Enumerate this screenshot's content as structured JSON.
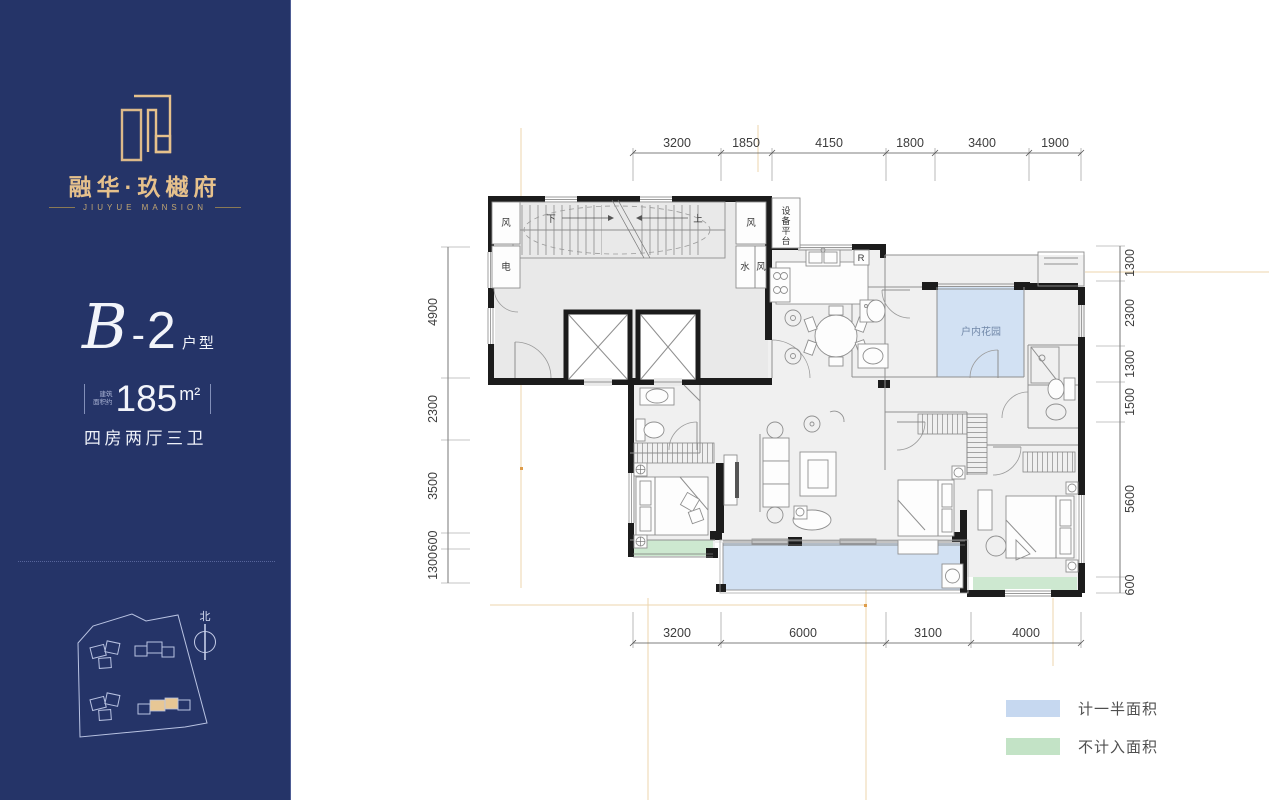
{
  "brand": {
    "title": "融华·玖樾府",
    "subtitle": "JIUYUE MANSION"
  },
  "unit": {
    "script": "B",
    "dash": "-",
    "number": "2",
    "suffix": "户型",
    "area_label_1": "建筑",
    "area_label_2": "面积约",
    "area_value": "185",
    "area_unit": "m²",
    "layout": "四房两厅三卫"
  },
  "compass": {
    "north": "北"
  },
  "plan": {
    "dims": {
      "top": [
        "3200",
        "1850",
        "4150",
        "1800",
        "3400",
        "1900"
      ],
      "left": [
        "4900",
        "2300",
        "3500",
        "600",
        "1300"
      ],
      "right": [
        "1300",
        "2300",
        "1300",
        "1500",
        "5600",
        "600"
      ],
      "bottom": [
        "3200",
        "6000",
        "3100",
        "4000"
      ]
    },
    "labels": {
      "wind1": "风",
      "wind2": "风",
      "wind3": "风",
      "electric": "电",
      "water": "水",
      "up": "上",
      "down": "下",
      "equipment": "设备平台",
      "garden": "户内花园",
      "fridge": "R"
    }
  },
  "legend": {
    "items": [
      {
        "label": "计一半面积",
        "color": "#c6d8f0"
      },
      {
        "label": "不计入面积",
        "color": "#c3e3c6"
      }
    ]
  },
  "colors": {
    "sidebar_bg": "#253468",
    "gold": "#e6c18c",
    "half_area_fill": "#d2e1f3",
    "excluded_fill": "#cde8d0",
    "core_fill": "#e9e9e9",
    "unit_fill": "#f0f0f0",
    "wall": "#1c1c1c",
    "guide": "#e9cf9f"
  }
}
